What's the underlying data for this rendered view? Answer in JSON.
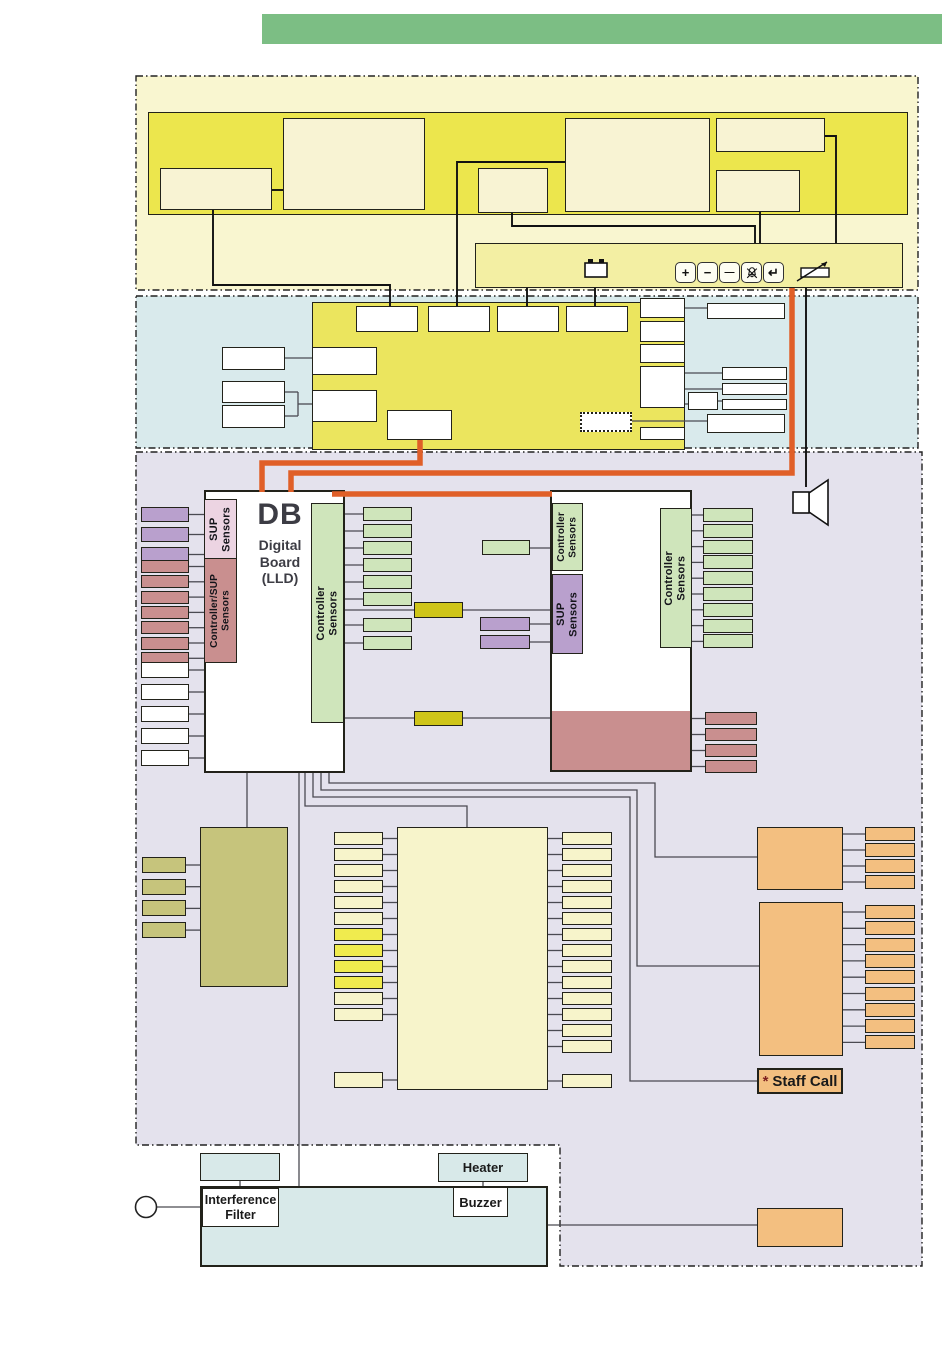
{
  "palette": {
    "header_green": "#7cbe84",
    "section_yellow_bg": "#f9f6d0",
    "panel_yellow": "#ece64d",
    "cream": "#f8f3d3",
    "bar_yellow": "#f3efa3",
    "section_blue_bg": "#d9eaec",
    "board_yellow": "#ebe55e",
    "section_lavender_bg": "#e4e2ed",
    "pink": "#ecd4e2",
    "mauve": "#c98f8f",
    "green": "#cfe5bb",
    "purple": "#b9a0cd",
    "olive": "#cfc519",
    "khaki": "#c6c47c",
    "pale_cream": "#f7f4cb",
    "bright_yellow": "#f0eb4e",
    "orange_box": "#f3bf80",
    "wire_orange": "#e05f28",
    "board_blue": "#d8e9e9",
    "white": "#ffffff",
    "line_gray": "#4a4a52",
    "line_black": "#111111"
  },
  "control_bar": {
    "icons": [
      {
        "name": "battery-icon"
      },
      {
        "name": "plus-button",
        "glyph": "+"
      },
      {
        "name": "minus-button",
        "glyph": "−"
      },
      {
        "name": "dash-button",
        "glyph": "—"
      },
      {
        "name": "alarm-mute-button"
      },
      {
        "name": "enter-button",
        "glyph": "↵"
      },
      {
        "name": "potentiometer-icon"
      }
    ]
  },
  "db_board": {
    "abbr": "DB",
    "name_lines": [
      "Digital",
      "Board",
      "(LLD)"
    ],
    "strip_sup": [
      "SUP",
      "Sensors"
    ],
    "strip_ctrl_sup": [
      "Controller/SUP",
      "Sensors"
    ],
    "strip_ctrl": [
      "Controller",
      "Sensors"
    ]
  },
  "right_board": {
    "strip_ctrl_top": [
      "Controller",
      "Sensors"
    ],
    "strip_sup": [
      "SUP",
      "Sensors"
    ],
    "strip_ctrl_inner": [
      "Controller",
      "Sensors"
    ]
  },
  "labels": {
    "staff_call_star": "*",
    "staff_call": "Staff Call",
    "heater": "Heater",
    "buzzer": "Buzzer",
    "interference_filter_lines": [
      "Interference",
      "Filter"
    ]
  },
  "groups": {
    "left_purple": {
      "count": 3
    },
    "left_mauve": {
      "count": 7
    },
    "left_white": {
      "count": 5
    },
    "db_green": {
      "count": 6
    },
    "db_green_extra": {
      "count": 2
    },
    "mid_purple": {
      "count": 2
    },
    "rb_green": {
      "count": 9
    },
    "rb_mauve": {
      "count": 4
    },
    "khaki_small": {
      "count": 4
    },
    "cream_left": {
      "count": 12
    },
    "cream_left_single": {
      "count": 1
    },
    "cream_right": {
      "count": 14
    },
    "cream_right_single": {
      "count": 1
    },
    "orange_top": {
      "count": 4
    },
    "orange_bottom": {
      "count": 9
    }
  }
}
